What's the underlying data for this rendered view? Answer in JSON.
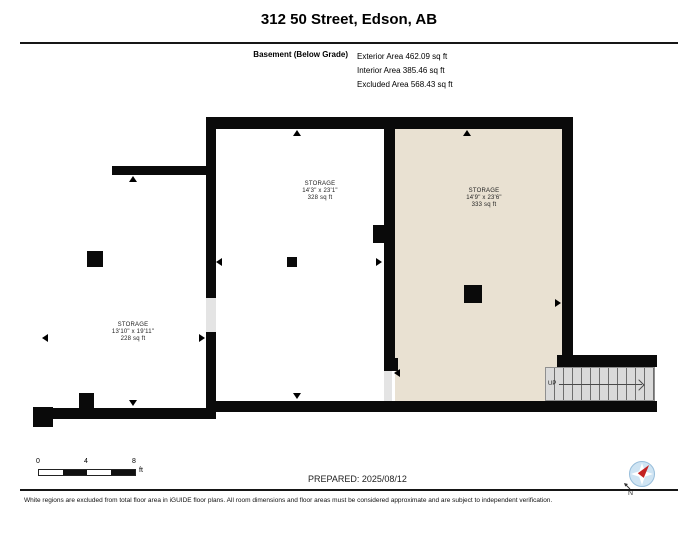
{
  "header": {
    "title": "312 50 Street, Edson, AB",
    "floor_label": "Basement (Below Grade)",
    "area_lines": [
      "Exterior Area 462.09 sq ft",
      "Interior Area 385.46 sq ft",
      "Excluded Area 568.43 sq ft"
    ]
  },
  "floor_plan": {
    "rooms": [
      {
        "name": "STORAGE",
        "dimensions": "13'10\" x 19'11\"",
        "area": "228 sq ft",
        "fill": "excluded-white"
      },
      {
        "name": "STORAGE",
        "dimensions": "14'3\" x 23'1\"",
        "area": "328 sq ft",
        "fill": "excluded-white"
      },
      {
        "name": "STORAGE",
        "dimensions": "14'9\" x 23'6\"",
        "area": "333 sq ft",
        "fill": "included-tan"
      }
    ],
    "stairs_label": "UP",
    "colors": {
      "wall": "#0a0a0a",
      "included_area_fill": "#e9e1d2",
      "excluded_area_fill": "#ffffff",
      "door_opening_fill": "#e4e4e4",
      "stairs_fill": "#dadada"
    }
  },
  "scale_bar": {
    "tick_labels": [
      "0",
      "4",
      "8"
    ],
    "unit": "ft"
  },
  "prepared_label": "PREPARED: 2025/08/12",
  "compass": {
    "north_label": "N",
    "needle_color": "#c32222",
    "ring_color": "#cfe4f3"
  },
  "footer": {
    "disclaimer": "White regions are excluded from total floor area in iGUIDE floor plans. All room dimensions and floor areas must be considered approximate and are subject to independent verification."
  }
}
